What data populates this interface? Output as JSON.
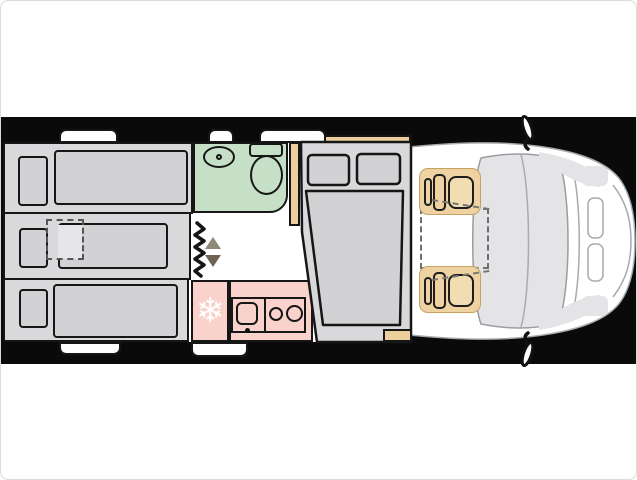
{
  "canvas": {
    "width": 637,
    "height": 480
  },
  "colors": {
    "band": "#0a0a0a",
    "outline": "#161616",
    "gray-block": "#d9d9db",
    "gray-soft": "#d2d2d5",
    "gray-light": "#e6e6e8",
    "green": "#c6dfc7",
    "pink": "#f8d2cb",
    "tan": "#eccf9c",
    "tan-seat": "#eed2a2",
    "vehicle-line": "#a6abaf",
    "shade": "#e4e4e6",
    "arrow-up": "#8e887a",
    "arrow-down": "#6f6355",
    "dash": "#6e6e6e",
    "page-border": "#dcdcdc"
  },
  "floorplan": {
    "kitchen": {
      "freezer_glyph": "❄"
    },
    "regions": [
      {
        "name": "rear-single-bed-top",
        "fill": "gray-block"
      },
      {
        "name": "rear-single-bed-middle-with-pullout",
        "fill": "gray-block"
      },
      {
        "name": "rear-single-bed-bottom",
        "fill": "gray-block"
      },
      {
        "name": "bathroom",
        "fill": "green"
      },
      {
        "name": "wardrobe",
        "fill": "tan"
      },
      {
        "name": "entry-area",
        "fill": "white"
      },
      {
        "name": "kitchen",
        "fill": "pink"
      },
      {
        "name": "french-bed",
        "fill": "gray-block"
      },
      {
        "name": "cab-seats",
        "fill": "tan-seat"
      },
      {
        "name": "vehicle-front",
        "fill": "white"
      }
    ]
  }
}
